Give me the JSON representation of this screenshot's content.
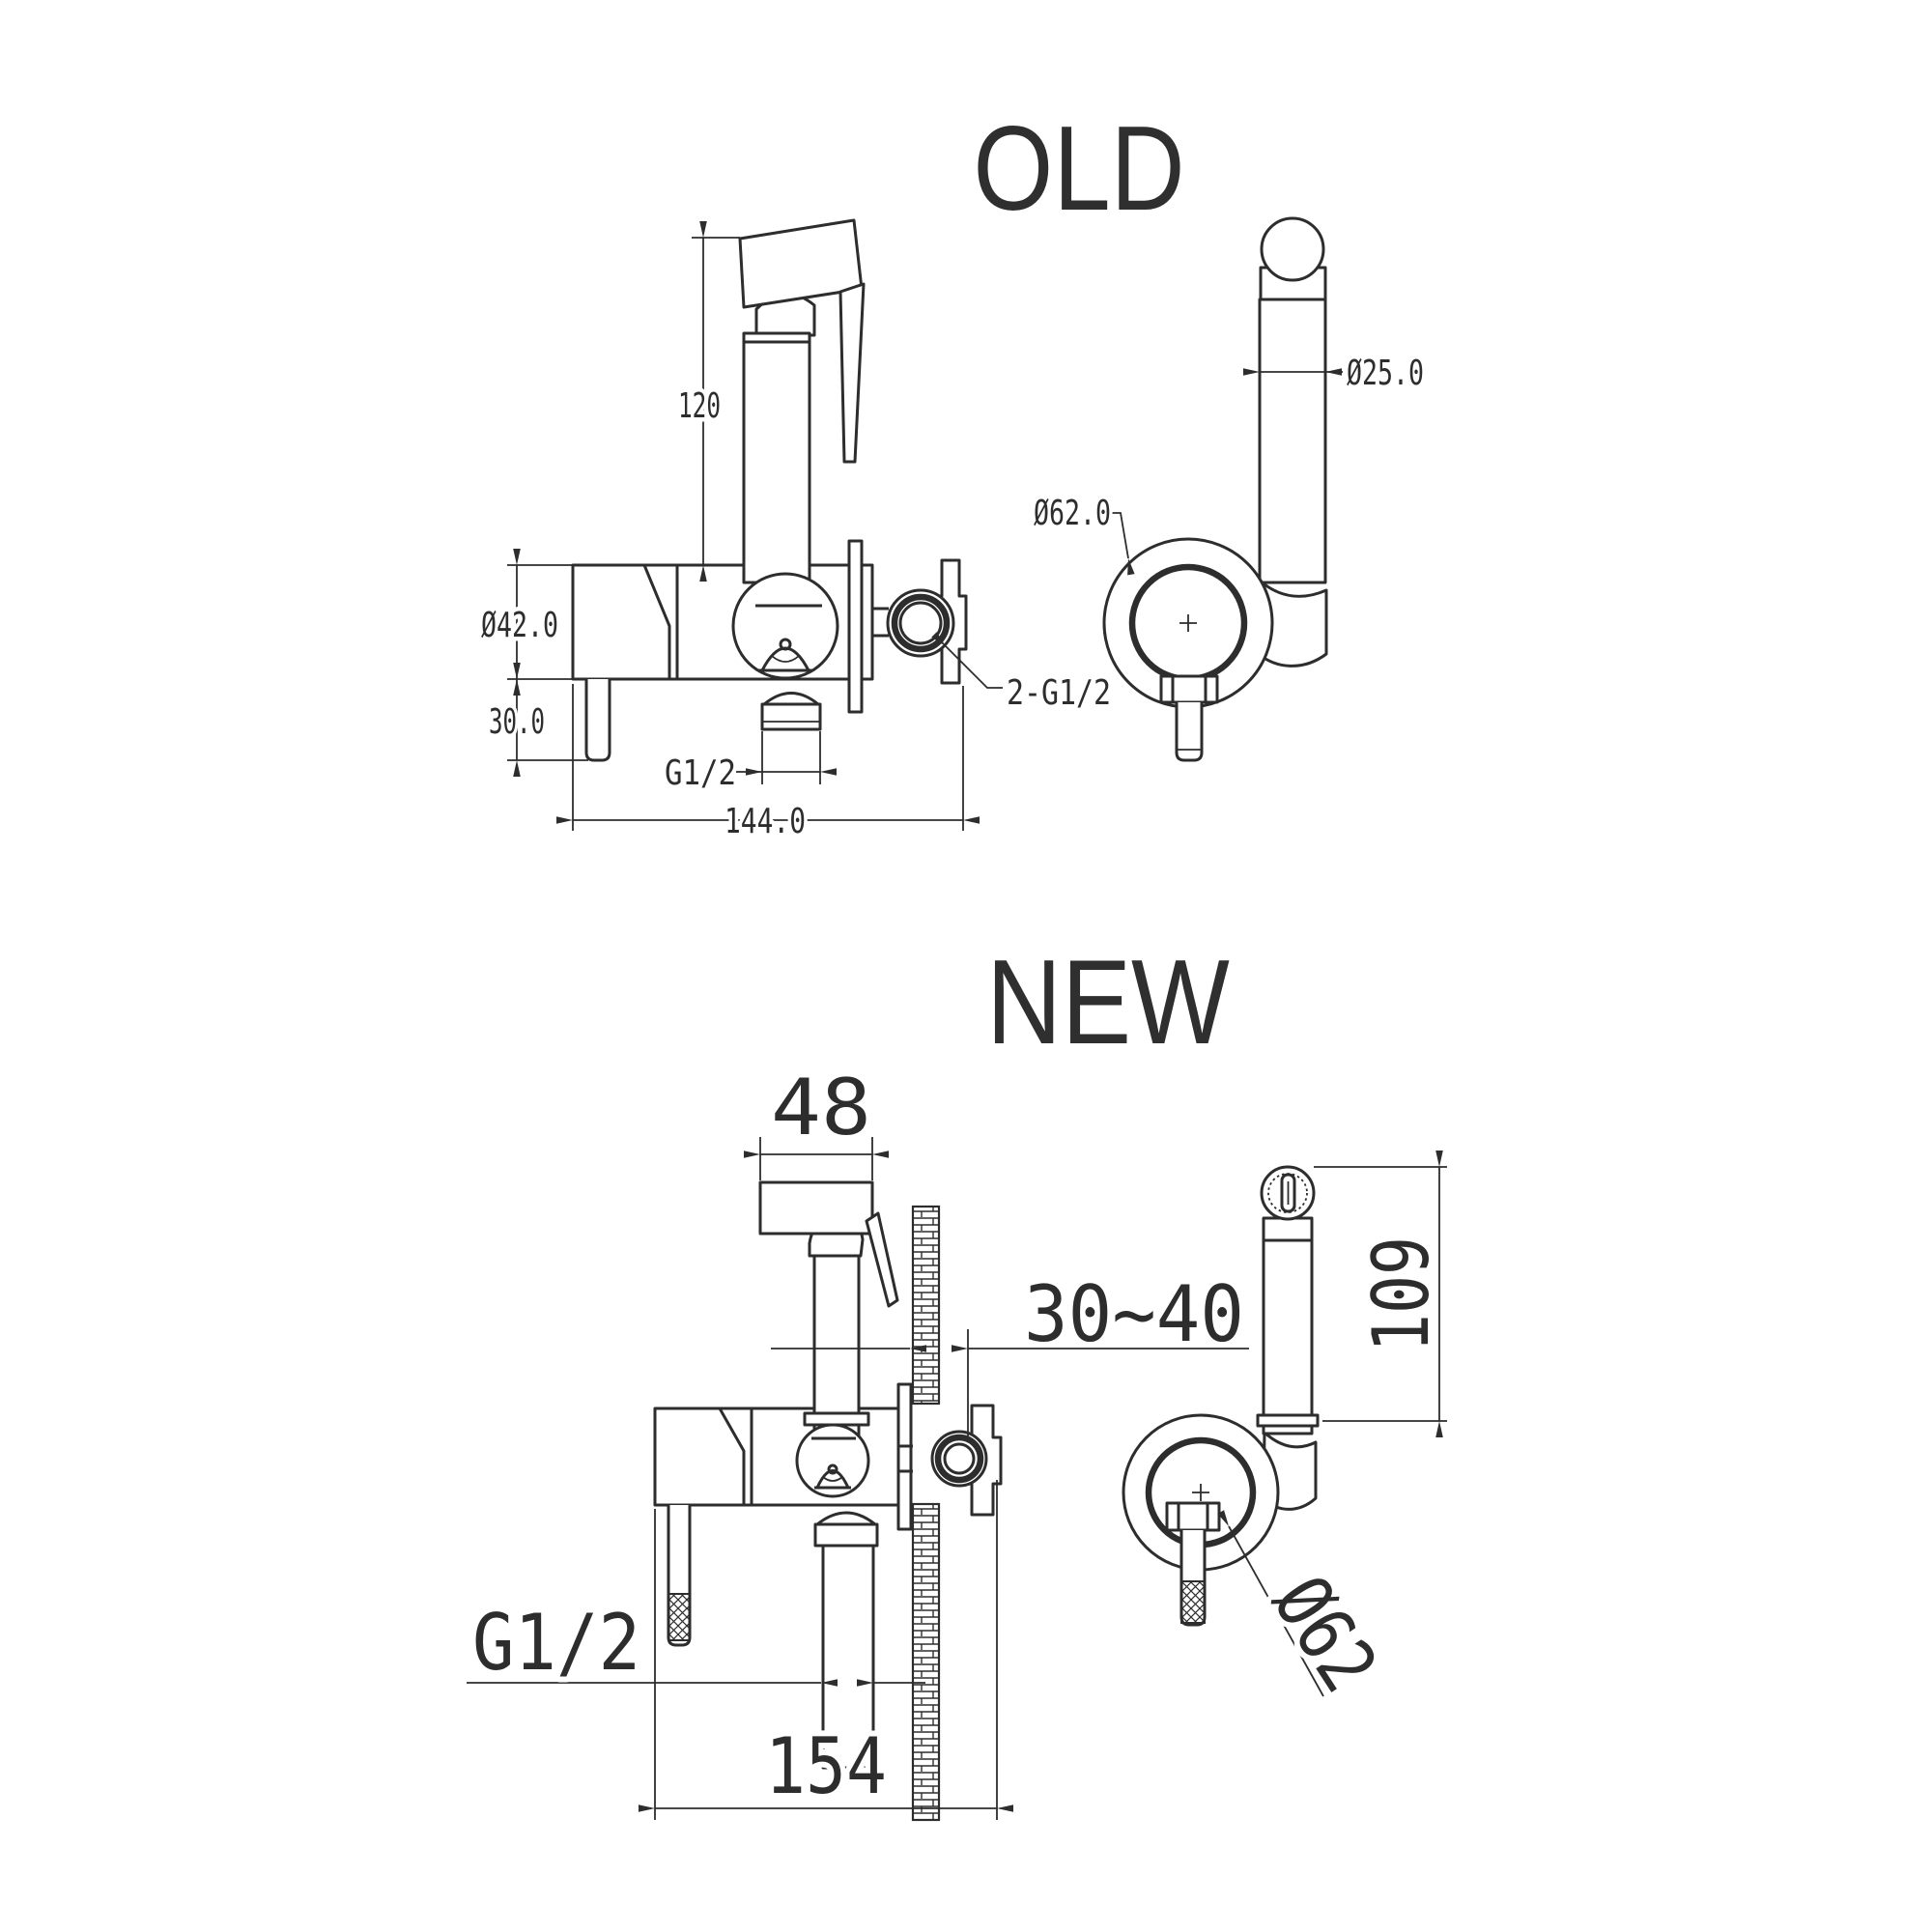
{
  "page": {
    "background": "#ffffff",
    "line_color": "#2d2d2d"
  },
  "old": {
    "title": "OLD",
    "front_view": {
      "dim_height": "120",
      "dim_body_diameter": "Ø42.0",
      "dim_inlet_drop": "30.0",
      "dim_outlet_thread": "G1/2",
      "dim_overall_width": "144.0"
    },
    "side_view": {
      "dim_head_diameter": "Ø25.0",
      "dim_holder_diameter": "Ø62.0",
      "dim_connection_note": "2-G1/2"
    }
  },
  "new": {
    "title": "NEW",
    "front_view": {
      "dim_head_width": "48",
      "dim_wall_thickness": "30~40",
      "dim_outlet_thread": "G1/2",
      "dim_overall_width": "154"
    },
    "side_view": {
      "dim_sprayer_height": "109",
      "dim_holder_diameter": "Ø62"
    }
  }
}
